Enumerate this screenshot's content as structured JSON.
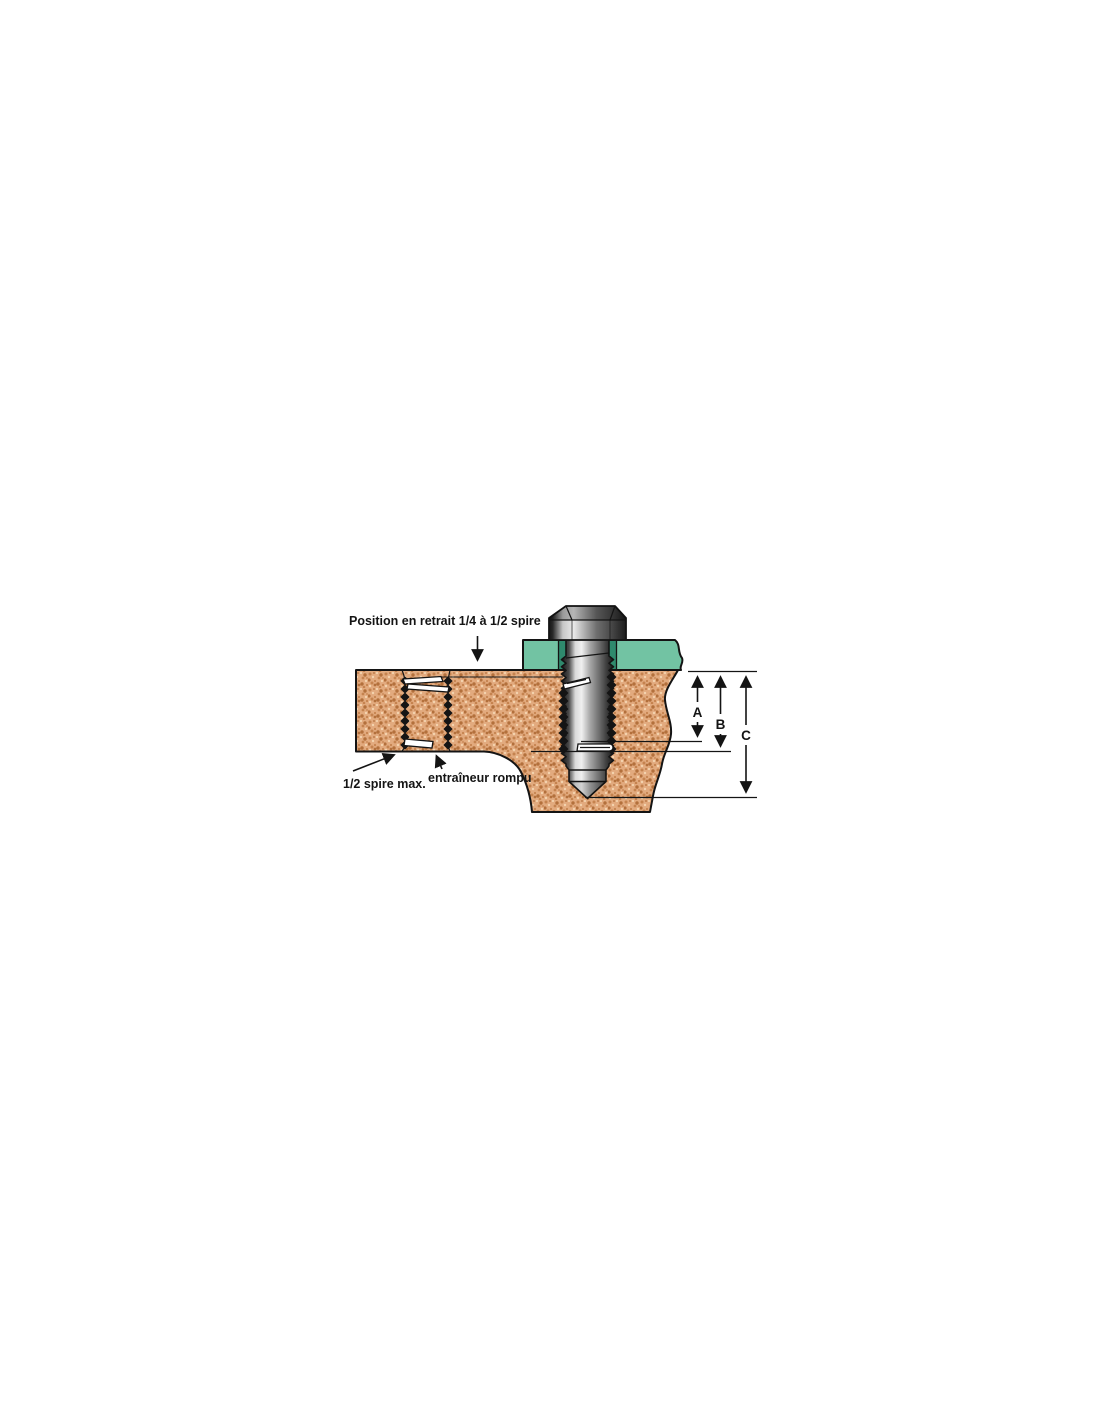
{
  "figure": {
    "labels": {
      "position": "Position en retrait 1/4 à 1/2 spire",
      "half_coil": "1/2 spire max.",
      "tang": "entraîneur rompu"
    },
    "dimensions": {
      "a": "A",
      "b": "B",
      "c": "C"
    },
    "colors": {
      "outline": "#141414",
      "material_base": "#e2aa7e",
      "material_speckle_dark": "#c5834f",
      "material_speckle_deep": "#b3703c",
      "material_speckle_light": "#f3d3ae",
      "plate_green": "#72c3a3",
      "plate_green_shadow": "#2f8a6d",
      "insert_black": "#141414",
      "tang_fill": "#ffffff"
    }
  }
}
